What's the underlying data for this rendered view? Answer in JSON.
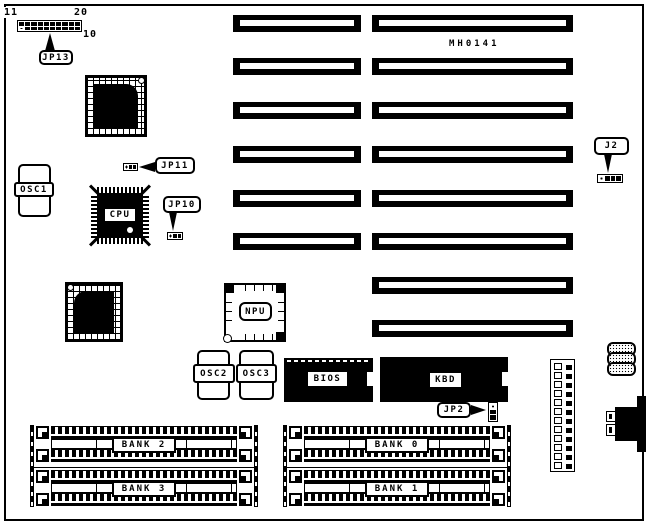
{
  "colors": {
    "ink": "#000000",
    "paper": "#ffffff"
  },
  "board": {
    "part_number": "MH0141"
  },
  "callouts": {
    "jp13": "JP13",
    "jp11": "JP11",
    "jp10": "JP10",
    "jp2": "JP2",
    "j2": "J2"
  },
  "chips": {
    "cpu": "CPU",
    "npu": "NPU",
    "bios": "BIOS",
    "kbd": "KBD"
  },
  "oscillators": {
    "osc1": "OSC1",
    "osc2": "OSC2",
    "osc3": "OSC3"
  },
  "jp13_header": {
    "rows": 2,
    "cols": 10,
    "pin_top_left": "11",
    "pin_top_right": "20",
    "pin_bottom_right": "10"
  },
  "slots": {
    "left_count": 6,
    "right_count": 8
  },
  "bank_blocks": [
    {
      "labels": [
        "BANK 2",
        "BANK 3"
      ]
    },
    {
      "labels": [
        "BANK 0",
        "BANK 1"
      ]
    }
  ],
  "power_connector": {
    "holes": 12,
    "pins": 12
  },
  "jumpers": {
    "jp11_pins": 3,
    "jp10_pins": 3,
    "jp2_pins": 3,
    "j2_pins": 4
  }
}
